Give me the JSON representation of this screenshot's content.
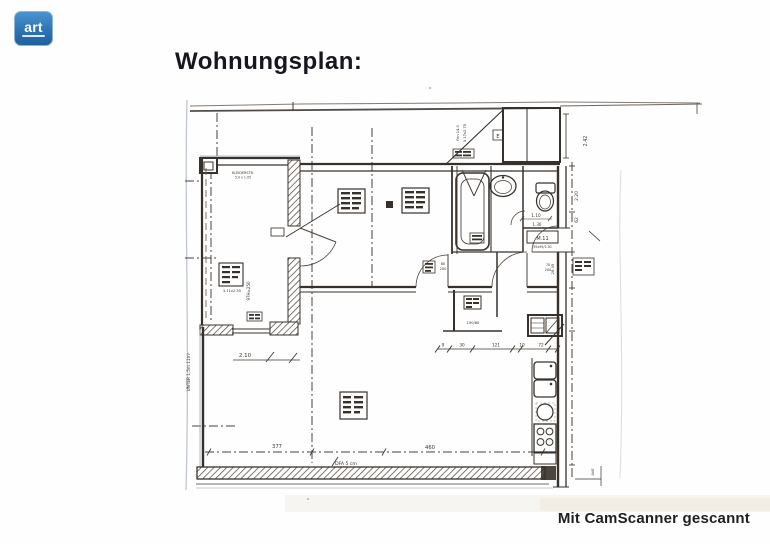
{
  "logo": {
    "text": "art"
  },
  "header": {
    "title": "Wohnungsplan:"
  },
  "footer": {
    "watermark": "Mit CamScanner gescannt"
  },
  "plan": {
    "annotations": {
      "closet_line1": "KLEIDERSTR.",
      "closet_line2": "5.0 x 1.05",
      "room1_dim": "3.11x2.55",
      "room1_note": "97H=250",
      "room1_width": "2.10",
      "slope_note": "UNTER 1,5m 11m²",
      "living_width": "377",
      "living_width2": "460",
      "floor_note": "DFA 5 cm",
      "bath_dim1": "1.10",
      "bath_dim2": "1.30",
      "door_tag": "M.11",
      "door_tag_sub": "95x95/1.30",
      "door1_w": "80",
      "door1_h": "200",
      "door2_w": "70",
      "door2_h": "200",
      "niche_dim": "190/80",
      "chain": [
        "9",
        "30",
        "121",
        "10",
        "72"
      ],
      "right_dim1": "2.42",
      "right_dim2": "2.20",
      "right_dim3": "62",
      "right_dim4": "28.05",
      "right_dim5": "AVE",
      "annex_note1": "Fen 14.0",
      "annex_note2": "5.17x2.75",
      "annex_mark": "E"
    }
  }
}
